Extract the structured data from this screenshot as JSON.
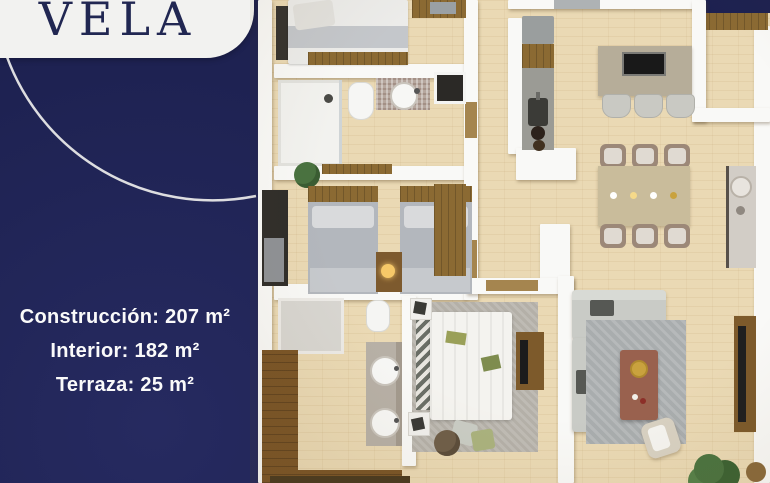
{
  "brand": {
    "name": "VELA"
  },
  "specs": {
    "construccion": "Construcción: 207 m²",
    "interior": "Interior: 182 m²",
    "terraza": "Terraza: 25 m²"
  },
  "colors": {
    "background_navy": "#1d2150",
    "card_white": "#f2f2f0",
    "logo_text_navy": "#212752",
    "specs_text_white": "#fafafa",
    "floor_wood_tan": "#ead9b4",
    "wall_white": "#f9f9f7",
    "cabinet_wood_brown": "#8b6a33",
    "counter_gray": "#9b9b95",
    "sofa_gray": "#c9cbc6",
    "rug_gray": "#a9adae",
    "plant_green": "#4b7340"
  },
  "floorplan": {
    "kind": "3d-top-down-apartment-render",
    "rooms": [
      "bedroom-1",
      "bathroom-1",
      "twin-bedroom",
      "hallway",
      "kitchen",
      "entry",
      "dining-room",
      "living-room",
      "master-bedroom",
      "master-bathroom",
      "walk-in-closet",
      "terrace"
    ]
  }
}
